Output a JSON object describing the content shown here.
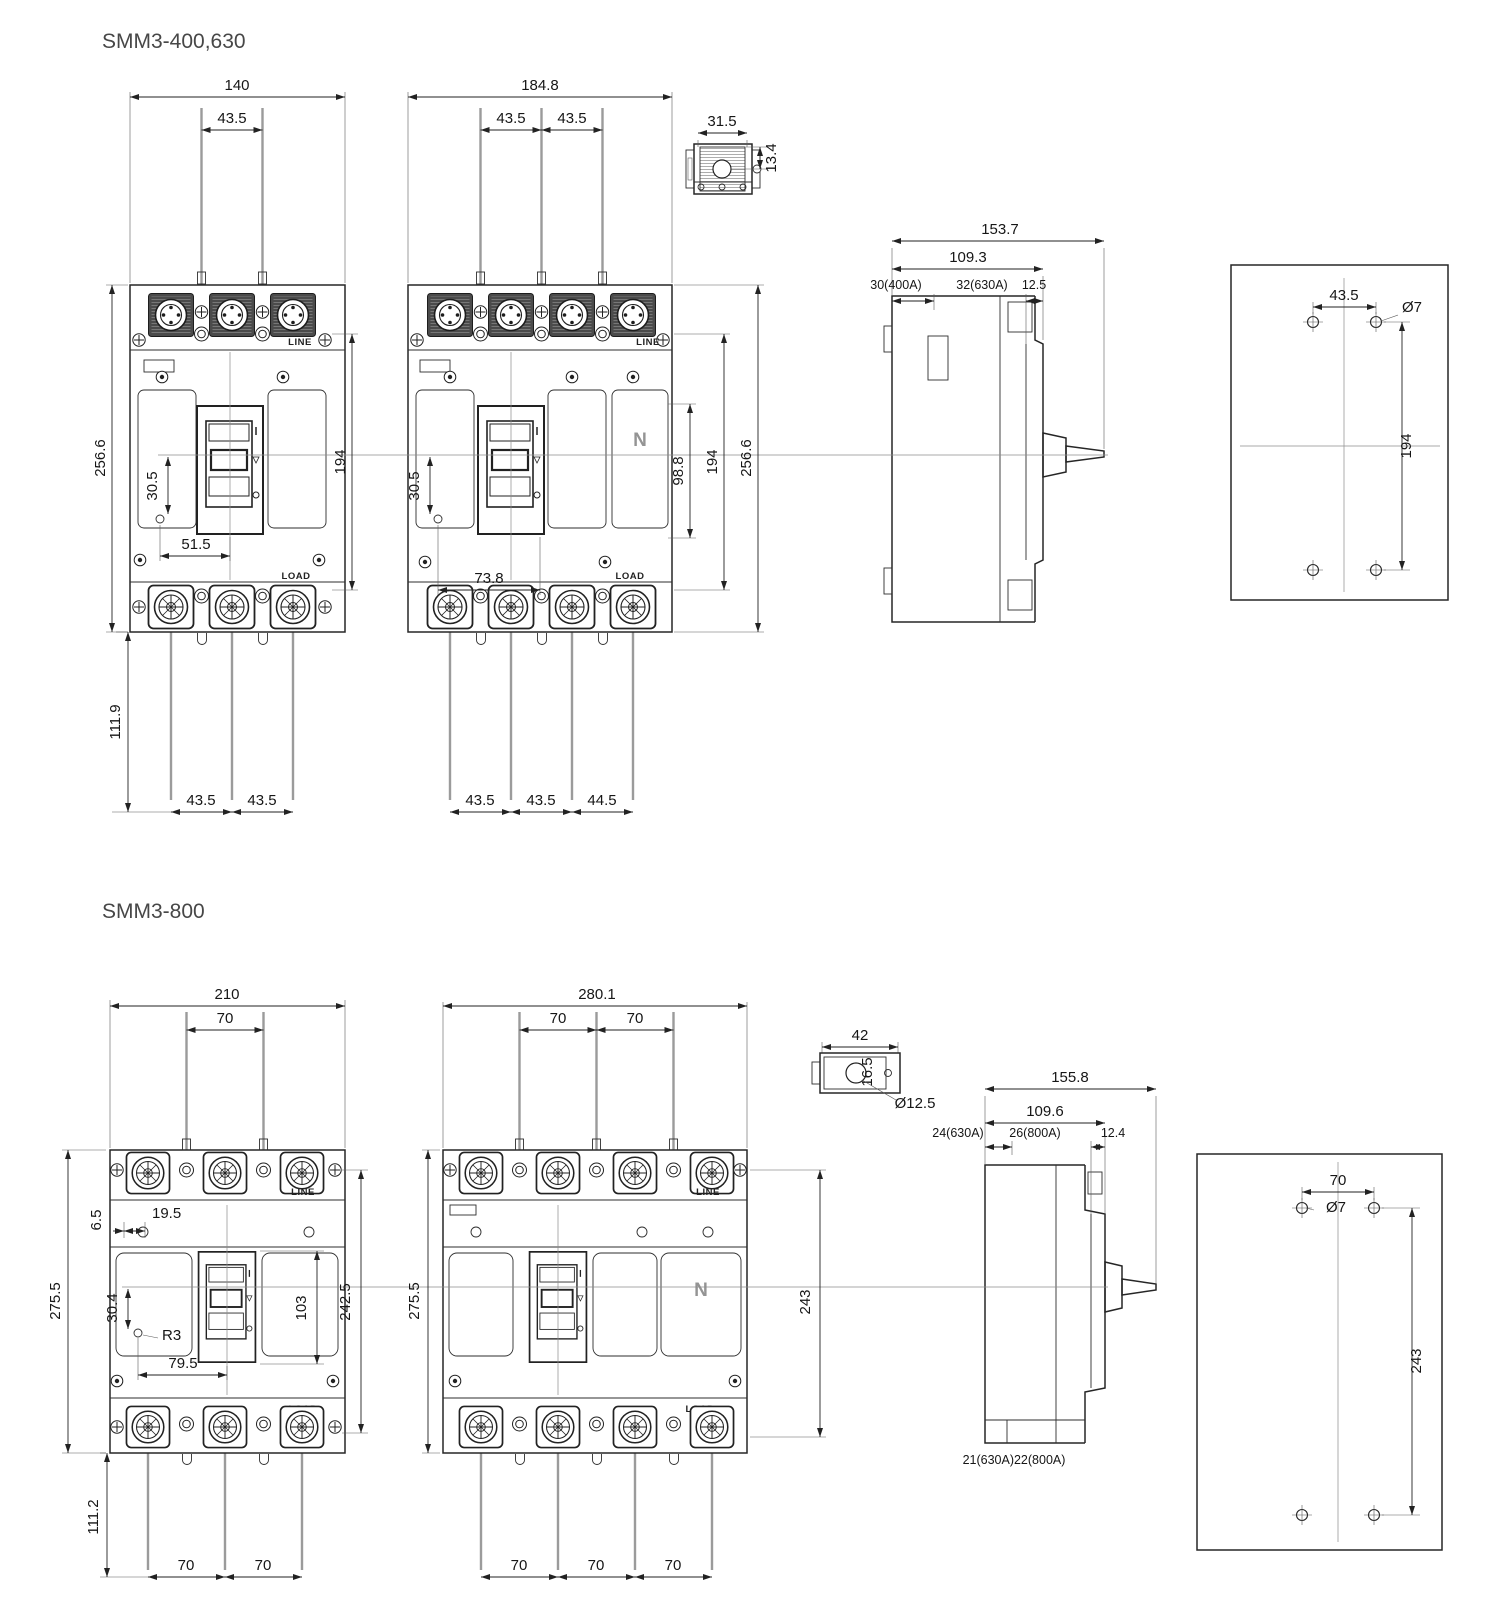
{
  "sections": {
    "s1": {
      "title": "SMM3-400,630",
      "front3": {
        "width": "140",
        "top_pitch": "43.5",
        "height": "256.6",
        "hole_dy": "30.5",
        "hole_dx": "51.5",
        "mount_v": "194",
        "lead_len": "111.9",
        "bot_pitch1": "43.5",
        "bot_pitch2": "43.5",
        "line": "LINE",
        "load": "LOAD"
      },
      "front4": {
        "width": "184.8",
        "top_pitch1": "43.5",
        "top_pitch2": "43.5",
        "hole_dy": "30.5",
        "hole_dx": "73.8",
        "n_dim": "98.8",
        "mount_v": "194",
        "height": "256.6",
        "bot_pitch1": "43.5",
        "bot_pitch2": "43.5",
        "bot_pitch3": "44.5",
        "neutral": "N",
        "line": "LINE",
        "load": "LOAD"
      },
      "lug": {
        "width": "31.5",
        "height": "13.4"
      },
      "side": {
        "depth": "153.7",
        "body_depth": "109.3",
        "dim_a": "30(400A)",
        "dim_b": "32(630A)",
        "dim_c": "12.5"
      },
      "plate": {
        "hole_pitch_x": "43.5",
        "hole_dia": "Ø7",
        "hole_pitch_y": "194"
      }
    },
    "s2": {
      "title": "SMM3-800",
      "front3": {
        "width": "210",
        "top_pitch": "70",
        "height": "275.5",
        "off_a": "6.5",
        "off_b": "19.5",
        "hole_dy": "30.4",
        "fillet": "R3",
        "hole_dx": "79.5",
        "handle_h": "103",
        "mount_v": "242.5",
        "lead_len": "111.2",
        "bot_pitch1": "70",
        "bot_pitch2": "70",
        "line": "LINE",
        "load": "LOAD"
      },
      "front4": {
        "width": "280.1",
        "top_pitch1": "70",
        "top_pitch2": "70",
        "height": "275.5",
        "mount_v": "243",
        "bot_pitch1": "70",
        "bot_pitch2": "70",
        "bot_pitch3": "70",
        "neutral": "N",
        "line": "LINE",
        "load": "LOAD"
      },
      "lug": {
        "width": "42",
        "height": "16.5",
        "hole_dia": "Ø12.5"
      },
      "side": {
        "depth": "155.8",
        "body_depth": "109.6",
        "dim_a": "24(630A)",
        "dim_b": "26(800A)",
        "dim_c": "12.4",
        "dim_bottom": "21(630A)22(800A)"
      },
      "plate": {
        "hole_pitch_x": "70",
        "hole_dia": "Ø7",
        "hole_pitch_y": "243"
      }
    }
  }
}
